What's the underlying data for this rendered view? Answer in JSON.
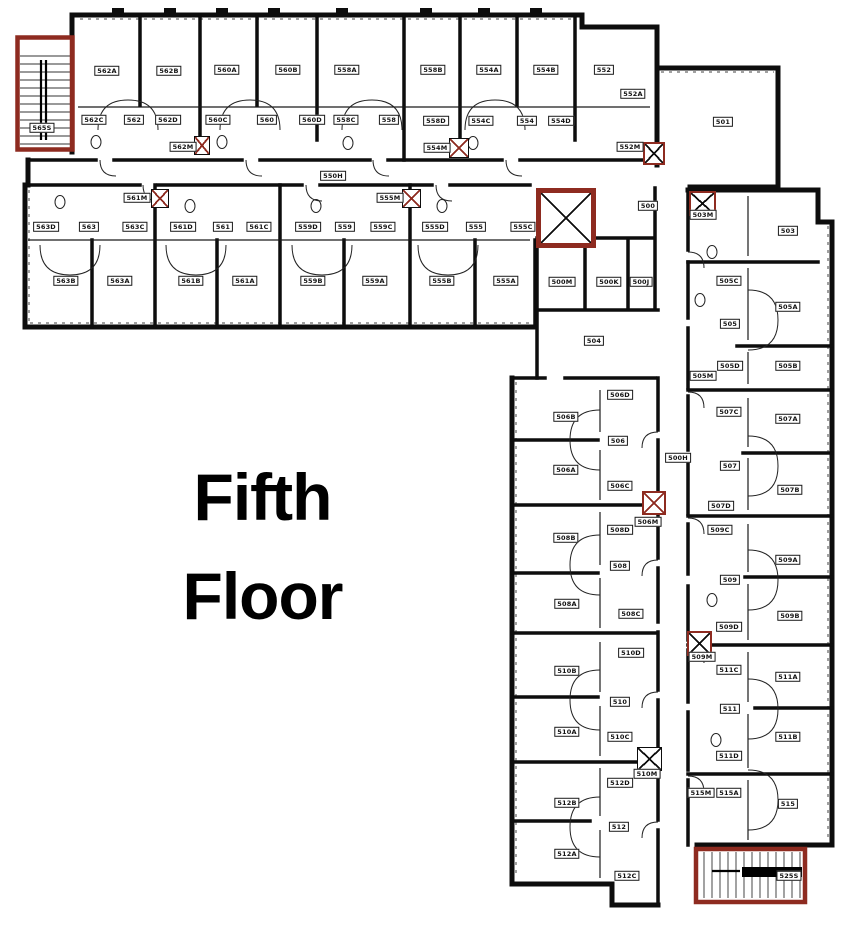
{
  "title": {
    "line1": "Fifth",
    "line2": "Floor"
  },
  "colors": {
    "wall": "#0d0d0d",
    "accent_red": "#8e2b20",
    "background": "#ffffff"
  },
  "floor": {
    "name": "Fifth Floor",
    "room_labels_format": [
      "label",
      "x_px",
      "y_px"
    ],
    "room_labels": [
      [
        "565S",
        42,
        128
      ],
      [
        "562A",
        107,
        71
      ],
      [
        "562B",
        169,
        71
      ],
      [
        "560A",
        227,
        70
      ],
      [
        "560B",
        288,
        70
      ],
      [
        "558A",
        347,
        70
      ],
      [
        "558B",
        433,
        70
      ],
      [
        "554A",
        489,
        70
      ],
      [
        "554B",
        546,
        70
      ],
      [
        "552",
        604,
        70
      ],
      [
        "562C",
        94,
        120
      ],
      [
        "562",
        134,
        120
      ],
      [
        "562D",
        168,
        120
      ],
      [
        "560C",
        218,
        120
      ],
      [
        "560",
        267,
        120
      ],
      [
        "560D",
        312,
        120
      ],
      [
        "558C",
        346,
        120
      ],
      [
        "558",
        389,
        120
      ],
      [
        "558D",
        436,
        121
      ],
      [
        "554C",
        481,
        121
      ],
      [
        "554",
        527,
        121
      ],
      [
        "554D",
        561,
        121
      ],
      [
        "552A",
        633,
        94
      ],
      [
        "562M",
        183,
        147
      ],
      [
        "554M",
        437,
        148
      ],
      [
        "552M",
        630,
        147
      ],
      [
        "550H",
        333,
        176
      ],
      [
        "563D",
        46,
        227
      ],
      [
        "563",
        89,
        227
      ],
      [
        "563C",
        135,
        227
      ],
      [
        "561M",
        137,
        198
      ],
      [
        "561D",
        183,
        227
      ],
      [
        "561",
        223,
        227
      ],
      [
        "561C",
        259,
        227
      ],
      [
        "559D",
        308,
        227
      ],
      [
        "559",
        345,
        227
      ],
      [
        "559C",
        383,
        227
      ],
      [
        "555M",
        390,
        198
      ],
      [
        "555D",
        435,
        227
      ],
      [
        "555",
        476,
        227
      ],
      [
        "555C",
        523,
        227
      ],
      [
        "563B",
        66,
        281
      ],
      [
        "563A",
        120,
        281
      ],
      [
        "561B",
        191,
        281
      ],
      [
        "561A",
        245,
        281
      ],
      [
        "559B",
        313,
        281
      ],
      [
        "559A",
        375,
        281
      ],
      [
        "555B",
        442,
        281
      ],
      [
        "555A",
        506,
        281
      ],
      [
        "500",
        648,
        206
      ],
      [
        "501",
        723,
        122
      ],
      [
        "500M",
        562,
        282
      ],
      [
        "500K",
        609,
        282
      ],
      [
        "500J",
        641,
        282
      ],
      [
        "504",
        594,
        341
      ],
      [
        "503M",
        703,
        215
      ],
      [
        "503",
        788,
        231
      ],
      [
        "505C",
        729,
        281
      ],
      [
        "505A",
        788,
        307
      ],
      [
        "505",
        730,
        324
      ],
      [
        "505D",
        730,
        366
      ],
      [
        "505B",
        788,
        366
      ],
      [
        "505M",
        703,
        376
      ],
      [
        "507C",
        729,
        412
      ],
      [
        "507A",
        788,
        419
      ],
      [
        "507",
        730,
        466
      ],
      [
        "500H",
        678,
        458
      ],
      [
        "507B",
        790,
        490
      ],
      [
        "507D",
        721,
        506
      ],
      [
        "509C",
        720,
        530
      ],
      [
        "509A",
        788,
        560
      ],
      [
        "509",
        730,
        580
      ],
      [
        "509B",
        790,
        616
      ],
      [
        "509D",
        729,
        627
      ],
      [
        "509M",
        702,
        657
      ],
      [
        "511C",
        729,
        670
      ],
      [
        "511A",
        788,
        677
      ],
      [
        "511",
        730,
        709
      ],
      [
        "511B",
        788,
        737
      ],
      [
        "511D",
        729,
        756
      ],
      [
        "515M",
        701,
        793
      ],
      [
        "515A",
        729,
        793
      ],
      [
        "515",
        788,
        804
      ],
      [
        "525S",
        789,
        876
      ],
      [
        "506D",
        620,
        395
      ],
      [
        "506B",
        566,
        417
      ],
      [
        "506",
        618,
        441
      ],
      [
        "506A",
        566,
        470
      ],
      [
        "506C",
        620,
        486
      ],
      [
        "506M",
        648,
        522
      ],
      [
        "508D",
        620,
        530
      ],
      [
        "508B",
        566,
        538
      ],
      [
        "508",
        620,
        566
      ],
      [
        "508A",
        567,
        604
      ],
      [
        "508C",
        631,
        614
      ],
      [
        "510D",
        631,
        653
      ],
      [
        "510B",
        567,
        671
      ],
      [
        "510",
        620,
        702
      ],
      [
        "510A",
        567,
        732
      ],
      [
        "510C",
        620,
        737
      ],
      [
        "510M",
        647,
        774
      ],
      [
        "512D",
        620,
        783
      ],
      [
        "512B",
        567,
        803
      ],
      [
        "512",
        619,
        827
      ],
      [
        "512A",
        567,
        854
      ],
      [
        "512C",
        627,
        876
      ]
    ],
    "markers_format": "x,y,w,h in px; border/cross colors",
    "markers": [
      {
        "name": "elevator-icon",
        "x": 536,
        "y": 188,
        "w": 50,
        "h": 50,
        "border": "red-thick",
        "cross": "black"
      },
      {
        "name": "elevator-icon",
        "x": 637,
        "y": 747,
        "w": 23,
        "h": 22,
        "border": "black",
        "cross": "black"
      },
      {
        "name": "trash-chute-icon",
        "x": 194,
        "y": 136,
        "w": 14,
        "h": 17,
        "border": "black",
        "cross": "red"
      },
      {
        "name": "trash-chute-icon",
        "x": 449,
        "y": 138,
        "w": 18,
        "h": 18,
        "border": "black",
        "cross": "red"
      },
      {
        "name": "trash-chute-icon",
        "x": 151,
        "y": 189,
        "w": 16,
        "h": 17,
        "border": "black",
        "cross": "red"
      },
      {
        "name": "trash-chute-icon",
        "x": 402,
        "y": 189,
        "w": 17,
        "h": 17,
        "border": "black",
        "cross": "red"
      },
      {
        "name": "trash-chute-icon",
        "x": 643,
        "y": 142,
        "w": 18,
        "h": 19,
        "border": "red",
        "cross": "black"
      },
      {
        "name": "trash-chute-icon",
        "x": 689,
        "y": 191,
        "w": 23,
        "h": 21,
        "border": "red",
        "cross": "black"
      },
      {
        "name": "trash-chute-icon",
        "x": 642,
        "y": 491,
        "w": 20,
        "h": 20,
        "border": "red",
        "cross": "red"
      },
      {
        "name": "trash-chute-icon",
        "x": 687,
        "y": 631,
        "w": 21,
        "h": 21,
        "border": "red",
        "cross": "black"
      }
    ]
  }
}
